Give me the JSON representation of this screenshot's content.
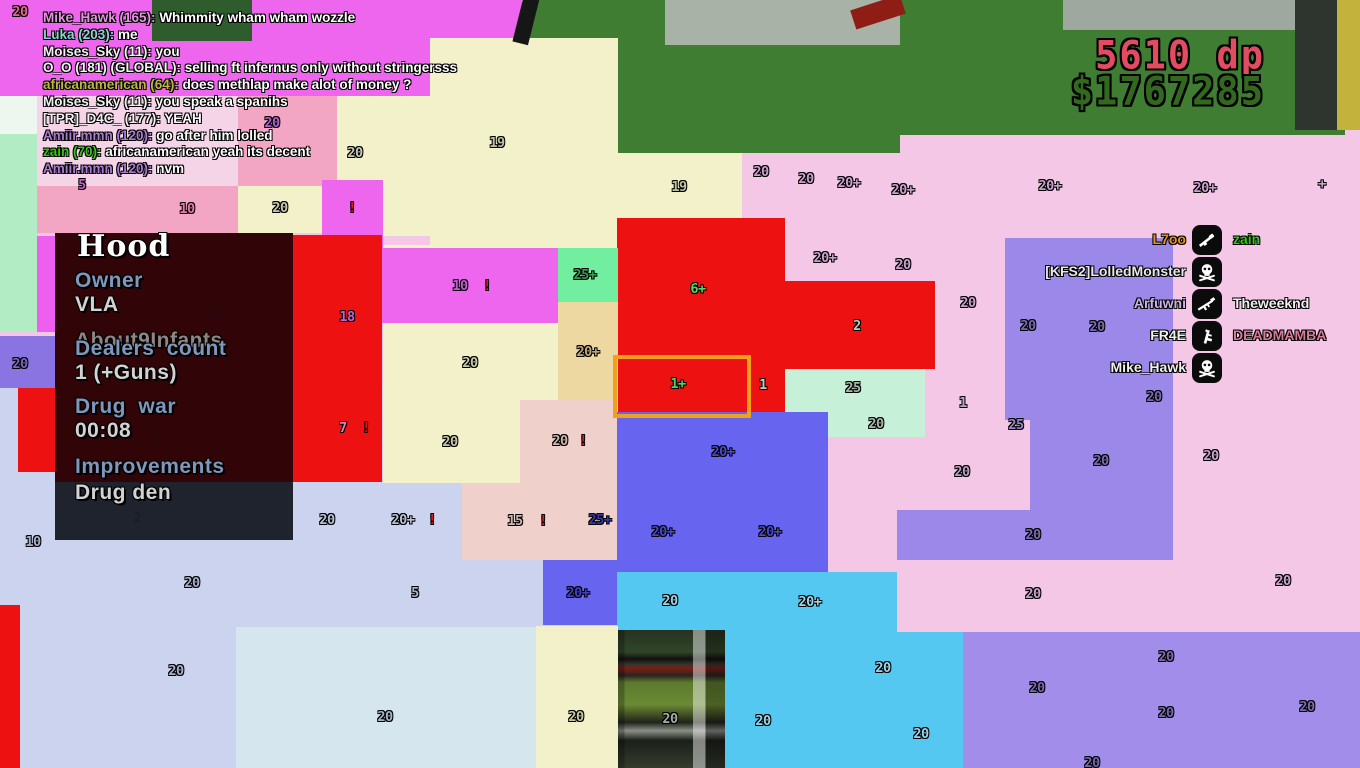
{
  "hud": {
    "score": "5610 dp",
    "score_color": "#e34b60",
    "money": "$1767285",
    "money_color": "#33691e"
  },
  "chat": {
    "lines": [
      {
        "name": "Mike_Hawk (165):",
        "name_color": "#e096dc",
        "message": "Whimmity wham wham wozzle"
      },
      {
        "name": "Luka (203):",
        "name_color": "#88d4cc",
        "message": "me"
      },
      {
        "name": "Moises_Sky (11):",
        "name_color": "#f0f0f0",
        "message": "you"
      },
      {
        "name": "O_O (181) (GLOBAL):",
        "name_color": "#f0f0f0",
        "message": "selling ft infernus only without stringersss"
      },
      {
        "name": "africanamerican (64):",
        "name_color": "#b8ba3e",
        "message": "does methlap make alot of money ?"
      },
      {
        "name": "Moises_Sky (11):",
        "name_color": "#f0f0f0",
        "message": "you speak a spanihs"
      },
      {
        "name": "[TPR]_D4C_ (177):",
        "name_color": "#f0f0f0",
        "message": "YEAH"
      },
      {
        "name": "Amiir.mmn (120):",
        "name_color": "#a87ad0",
        "message": "go after him lolled"
      },
      {
        "name": "zain (70):",
        "name_color": "#35c418",
        "message": "africanamerican yeah its decent"
      },
      {
        "name": "Amiir.mmn (120):",
        "name_color": "#a87ad0",
        "message": "nvm"
      }
    ]
  },
  "kill_feed": {
    "rows": [
      {
        "killer": "L7oo",
        "killer_color": "#e8921c",
        "weapon_icon": "sawnoff-shotgun-icon",
        "victim": "zain",
        "victim_color": "#35c418"
      },
      {
        "killer": "[KFS2]LolledMonster",
        "killer_color": "#e8e8e8",
        "weapon_icon": "skull-icon",
        "victim": "",
        "victim_color": "#ffffff"
      },
      {
        "killer": "Arfuwni",
        "killer_color": "#cbb4e4",
        "weapon_icon": "rifle-icon",
        "victim": "Theweeknd",
        "victim_color": "#f0f0f0"
      },
      {
        "killer": "FR4E",
        "killer_color": "#f0f0f0",
        "weapon_icon": "tec9-icon",
        "victim": "DEADMAMBA",
        "victim_color": "#d87a9a"
      },
      {
        "killer": "Mike_Hawk",
        "killer_color": "#f0f0f0",
        "weapon_icon": "skull-icon",
        "victim": "",
        "victim_color": "#ffffff"
      }
    ]
  },
  "hood_panel": {
    "title": "Hood",
    "owner_label": "Owner",
    "owner_value": "VLA",
    "gang_ghost_text": "About9Infants",
    "dealers_label": "Dealers count",
    "dealers_value": "1 (+Guns)",
    "drug_war_label": "Drug war",
    "drug_war_timer": "00:08",
    "improvements_label": "Improvements",
    "improvements_value": "Drug den"
  },
  "map": {
    "selection": {
      "x": 613,
      "y": 355,
      "w": 130,
      "h": 55,
      "border_color": "#f0a11c"
    },
    "territories": [
      {
        "x": 0,
        "y": 385,
        "w": 620,
        "h": 383,
        "c": "#ccd3ef"
      },
      {
        "x": 236,
        "y": 627,
        "w": 300,
        "h": 141,
        "c": "#d6e6ef"
      },
      {
        "x": 337,
        "y": 96,
        "w": 105,
        "h": 140,
        "c": "#f2f1c9"
      },
      {
        "x": 430,
        "y": 37,
        "w": 190,
        "h": 212,
        "c": "#f2f1c9"
      },
      {
        "x": 618,
        "y": 135,
        "w": 124,
        "h": 112,
        "c": "#f2f1c9"
      },
      {
        "x": 383,
        "y": 245,
        "w": 177,
        "h": 238,
        "c": "#f2f1c9"
      },
      {
        "x": 238,
        "y": 180,
        "w": 84,
        "h": 53,
        "c": "#f2f1c9"
      },
      {
        "x": 238,
        "y": 96,
        "w": 99,
        "h": 90,
        "c": "#f2a6c4"
      },
      {
        "x": 37,
        "y": 180,
        "w": 201,
        "h": 53,
        "c": "#f2a6c4"
      },
      {
        "x": 0,
        "y": 96,
        "w": 238,
        "h": 90,
        "c": "#f6d4e8"
      },
      {
        "x": 0,
        "y": 96,
        "w": 37,
        "h": 40,
        "c": "#eef6f0"
      },
      {
        "x": 0,
        "y": 134,
        "w": 37,
        "h": 198,
        "c": "#b2ecc4"
      },
      {
        "x": 0,
        "y": 0,
        "w": 430,
        "h": 96,
        "c": "#ee66ee"
      },
      {
        "x": 430,
        "y": 0,
        "w": 92,
        "h": 38,
        "c": "#ee66ee"
      },
      {
        "x": 322,
        "y": 180,
        "w": 61,
        "h": 77,
        "c": "#ee66ee"
      },
      {
        "x": 322,
        "y": 248,
        "w": 238,
        "h": 75,
        "c": "#ee66ee"
      },
      {
        "x": 37,
        "y": 236,
        "w": 18,
        "h": 96,
        "c": "#ee5ff0"
      },
      {
        "x": 152,
        "y": 0,
        "w": 100,
        "h": 41,
        "c": "#2f5c2c"
      },
      {
        "x": 523,
        "y": 0,
        "w": 95,
        "h": 38,
        "c": "#3f7d32"
      },
      {
        "x": 618,
        "y": 0,
        "w": 282,
        "h": 153,
        "c": "#3f7d32"
      },
      {
        "x": 900,
        "y": 0,
        "w": 445,
        "h": 135,
        "c": "#3f7d32"
      },
      {
        "x": 665,
        "y": 0,
        "w": 235,
        "h": 45,
        "c": "#a9b2a7"
      },
      {
        "x": 1063,
        "y": 0,
        "w": 232,
        "h": 30,
        "c": "#9fa89e"
      },
      {
        "x": 1295,
        "y": 0,
        "w": 42,
        "h": 130,
        "c": "#2e352e"
      },
      {
        "x": 1337,
        "y": 0,
        "w": 23,
        "h": 130,
        "c": "#c3b23c"
      },
      {
        "x": 852,
        "y": 2,
        "w": 52,
        "h": 20,
        "c": "#8e1d15",
        "rot": -18
      },
      {
        "x": 518,
        "y": -4,
        "w": 16,
        "h": 48,
        "c": "#161616",
        "rot": 14
      },
      {
        "x": 0,
        "y": 336,
        "w": 55,
        "h": 52,
        "c": "#8a74e2"
      },
      {
        "x": 18,
        "y": 388,
        "w": 37,
        "h": 84,
        "c": "#ee1111"
      },
      {
        "x": 0,
        "y": 605,
        "w": 20,
        "h": 163,
        "c": "#ee1111"
      },
      {
        "x": 55,
        "y": 233,
        "w": 238,
        "h": 249,
        "c": "#d40f0f"
      },
      {
        "x": 293,
        "y": 235,
        "w": 89,
        "h": 247,
        "c": "#ee1111"
      },
      {
        "x": 617,
        "y": 218,
        "w": 168,
        "h": 194,
        "c": "#ee1111"
      },
      {
        "x": 783,
        "y": 281,
        "w": 152,
        "h": 88,
        "c": "#ee1111"
      },
      {
        "x": 558,
        "y": 248,
        "w": 60,
        "h": 54,
        "c": "#72eea0"
      },
      {
        "x": 558,
        "y": 302,
        "w": 60,
        "h": 100,
        "c": "#eed8a2"
      },
      {
        "x": 520,
        "y": 400,
        "w": 98,
        "h": 83,
        "c": "#efd0ca"
      },
      {
        "x": 462,
        "y": 483,
        "w": 156,
        "h": 77,
        "c": "#efd0ca"
      },
      {
        "x": 785,
        "y": 369,
        "w": 140,
        "h": 68,
        "c": "#c6f0d8"
      },
      {
        "x": 617,
        "y": 412,
        "w": 211,
        "h": 160,
        "c": "#6765ef"
      },
      {
        "x": 543,
        "y": 560,
        "w": 75,
        "h": 65,
        "c": "#6765ef"
      },
      {
        "x": 617,
        "y": 572,
        "w": 280,
        "h": 60,
        "c": "#54c8f0"
      },
      {
        "x": 617,
        "y": 632,
        "w": 346,
        "h": 136,
        "c": "#54c8f0"
      },
      {
        "x": 536,
        "y": 626,
        "w": 82,
        "h": 142,
        "c": "#f2f1c9"
      },
      {
        "x": 1005,
        "y": 238,
        "w": 168,
        "h": 182,
        "c": "#9c88e8"
      },
      {
        "x": 1030,
        "y": 420,
        "w": 143,
        "h": 140,
        "c": "#9c88e8"
      },
      {
        "x": 897,
        "y": 510,
        "w": 276,
        "h": 50,
        "c": "#9c88e8"
      },
      {
        "x": 963,
        "y": 632,
        "w": 397,
        "h": 136,
        "c": "#a28eea"
      }
    ],
    "zone_labels": [
      {
        "text": "20",
        "x": 20,
        "y": 12,
        "c": "#e06a8a"
      },
      {
        "text": "20",
        "x": 272,
        "y": 123,
        "c": "#b45fd0"
      },
      {
        "text": "20",
        "x": 355,
        "y": 153,
        "c": "#c8c8b8"
      },
      {
        "text": "19",
        "x": 497,
        "y": 143,
        "c": "#c0c0a8"
      },
      {
        "text": "5",
        "x": 82,
        "y": 185,
        "c": "#c060c8"
      },
      {
        "text": "10",
        "x": 187,
        "y": 209,
        "c": "#e87aa8"
      },
      {
        "text": "20",
        "x": 280,
        "y": 208,
        "c": "#c8c8b0"
      },
      {
        "text": "!",
        "x": 352,
        "y": 208,
        "c": "#d81818"
      },
      {
        "text": "19",
        "x": 679,
        "y": 187,
        "c": "#c0c0a8"
      },
      {
        "text": "20",
        "x": 761,
        "y": 172,
        "c": "#c9a0ce"
      },
      {
        "text": "20",
        "x": 806,
        "y": 179,
        "c": "#c9a0ce"
      },
      {
        "text": "20+",
        "x": 849,
        "y": 183,
        "c": "#c9a0ce"
      },
      {
        "text": "20+",
        "x": 903,
        "y": 190,
        "c": "#c9a0ce"
      },
      {
        "text": "20+",
        "x": 1050,
        "y": 186,
        "c": "#c9a0ce"
      },
      {
        "text": "20+",
        "x": 1205,
        "y": 188,
        "c": "#c9a0ce"
      },
      {
        "text": "+",
        "x": 1322,
        "y": 184,
        "c": "#c9a0ce"
      },
      {
        "text": "20+",
        "x": 825,
        "y": 258,
        "c": "#c9a0ce"
      },
      {
        "text": "20",
        "x": 903,
        "y": 265,
        "c": "#c9a0ce"
      },
      {
        "text": "20",
        "x": 968,
        "y": 303,
        "c": "#c9a0ce"
      },
      {
        "text": "10",
        "x": 460,
        "y": 286,
        "c": "#c05fd0"
      },
      {
        "text": "!",
        "x": 487,
        "y": 286,
        "c": "#d81818"
      },
      {
        "text": "25+",
        "x": 585,
        "y": 275,
        "c": "#3a9a50"
      },
      {
        "text": "6+",
        "x": 698,
        "y": 289,
        "c": "#52d860"
      },
      {
        "text": "18",
        "x": 347,
        "y": 317,
        "c": "#c85fc8"
      },
      {
        "text": "2",
        "x": 857,
        "y": 326,
        "c": "#b8c8b8"
      },
      {
        "text": "12",
        "x": 215,
        "y": 313,
        "c": "#55406a",
        "faint": true
      },
      {
        "text": "20",
        "x": 1028,
        "y": 326,
        "c": "#776aae"
      },
      {
        "text": "20",
        "x": 1097,
        "y": 327,
        "c": "#776aae"
      },
      {
        "text": "20",
        "x": 20,
        "y": 364,
        "c": "#7a68c0"
      },
      {
        "text": "20",
        "x": 470,
        "y": 363,
        "c": "#c8c8a8"
      },
      {
        "text": "20+",
        "x": 588,
        "y": 352,
        "c": "#c0a878"
      },
      {
        "text": "1+",
        "x": 678,
        "y": 384,
        "c": "#48d858"
      },
      {
        "text": "1",
        "x": 763,
        "y": 385,
        "c": "#c8c8c0"
      },
      {
        "text": "25",
        "x": 853,
        "y": 388,
        "c": "#a8b8a8"
      },
      {
        "text": "20",
        "x": 876,
        "y": 424,
        "c": "#a8b8a8"
      },
      {
        "text": "1",
        "x": 963,
        "y": 403,
        "c": "#b9a8c0"
      },
      {
        "text": "25",
        "x": 1016,
        "y": 425,
        "c": "#9a86c8"
      },
      {
        "text": "20",
        "x": 962,
        "y": 472,
        "c": "#b9a0c4"
      },
      {
        "text": "20",
        "x": 1101,
        "y": 461,
        "c": "#776aae"
      },
      {
        "text": "20",
        "x": 1154,
        "y": 397,
        "c": "#776aae"
      },
      {
        "text": "20",
        "x": 1211,
        "y": 456,
        "c": "#c9a0ce"
      },
      {
        "text": "7",
        "x": 343,
        "y": 428,
        "c": "#e87aa8"
      },
      {
        "text": "!",
        "x": 366,
        "y": 428,
        "c": "#d81818"
      },
      {
        "text": "3 !",
        "x": 162,
        "y": 435,
        "c": "#6a3040",
        "faint": true
      },
      {
        "text": "20",
        "x": 450,
        "y": 442,
        "c": "#c8c8a8"
      },
      {
        "text": "20",
        "x": 560,
        "y": 441,
        "c": "#c8b8b0"
      },
      {
        "text": "!",
        "x": 583,
        "y": 441,
        "c": "#d81818"
      },
      {
        "text": "20+",
        "x": 723,
        "y": 452,
        "c": "#4848c8"
      },
      {
        "text": "2",
        "x": 137,
        "y": 518,
        "c": "#403048",
        "faint": true
      },
      {
        "text": "15",
        "x": 515,
        "y": 521,
        "c": "#c8b8b0"
      },
      {
        "text": "!",
        "x": 543,
        "y": 521,
        "c": "#d81818"
      },
      {
        "text": "20+",
        "x": 403,
        "y": 520,
        "c": "#b8c0d8"
      },
      {
        "text": "!",
        "x": 432,
        "y": 520,
        "c": "#d81818"
      },
      {
        "text": "20",
        "x": 327,
        "y": 520,
        "c": "#b8c0d8"
      },
      {
        "text": "25+",
        "x": 600,
        "y": 520,
        "c": "#3838a8"
      },
      {
        "text": "20+",
        "x": 663,
        "y": 532,
        "c": "#4848c8"
      },
      {
        "text": "20+",
        "x": 770,
        "y": 532,
        "c": "#4848c8"
      },
      {
        "text": "20",
        "x": 1033,
        "y": 535,
        "c": "#776aae"
      },
      {
        "text": "10",
        "x": 33,
        "y": 542,
        "c": "#a8b0cc"
      },
      {
        "text": "20",
        "x": 192,
        "y": 583,
        "c": "#a8b0cc"
      },
      {
        "text": "5",
        "x": 415,
        "y": 593,
        "c": "#a8b0cc"
      },
      {
        "text": "20+",
        "x": 578,
        "y": 593,
        "c": "#4040c0"
      },
      {
        "text": "20",
        "x": 670,
        "y": 601,
        "c": "#9ad4e8"
      },
      {
        "text": "20+",
        "x": 810,
        "y": 602,
        "c": "#9ad4e8"
      },
      {
        "text": "20",
        "x": 1283,
        "y": 581,
        "c": "#c9a0ce"
      },
      {
        "text": "20",
        "x": 1033,
        "y": 594,
        "c": "#c9a0ce"
      },
      {
        "text": "20",
        "x": 176,
        "y": 671,
        "c": "#a8b0cc"
      },
      {
        "text": "20",
        "x": 385,
        "y": 717,
        "c": "#a8b0cc"
      },
      {
        "text": "20",
        "x": 576,
        "y": 717,
        "c": "#c8c8a0"
      },
      {
        "text": "20",
        "x": 670,
        "y": 719,
        "c": "#a0b0a0"
      },
      {
        "text": "20",
        "x": 763,
        "y": 721,
        "c": "#9ad4e8"
      },
      {
        "text": "20",
        "x": 883,
        "y": 668,
        "c": "#9ad4e8"
      },
      {
        "text": "20",
        "x": 921,
        "y": 734,
        "c": "#9ad4e8"
      },
      {
        "text": "20",
        "x": 1166,
        "y": 657,
        "c": "#776aae"
      },
      {
        "text": "20",
        "x": 1037,
        "y": 688,
        "c": "#776aae"
      },
      {
        "text": "20",
        "x": 1166,
        "y": 713,
        "c": "#776aae"
      },
      {
        "text": "20",
        "x": 1307,
        "y": 707,
        "c": "#776aae"
      },
      {
        "text": "20",
        "x": 1092,
        "y": 763,
        "c": "#776aae"
      }
    ]
  }
}
